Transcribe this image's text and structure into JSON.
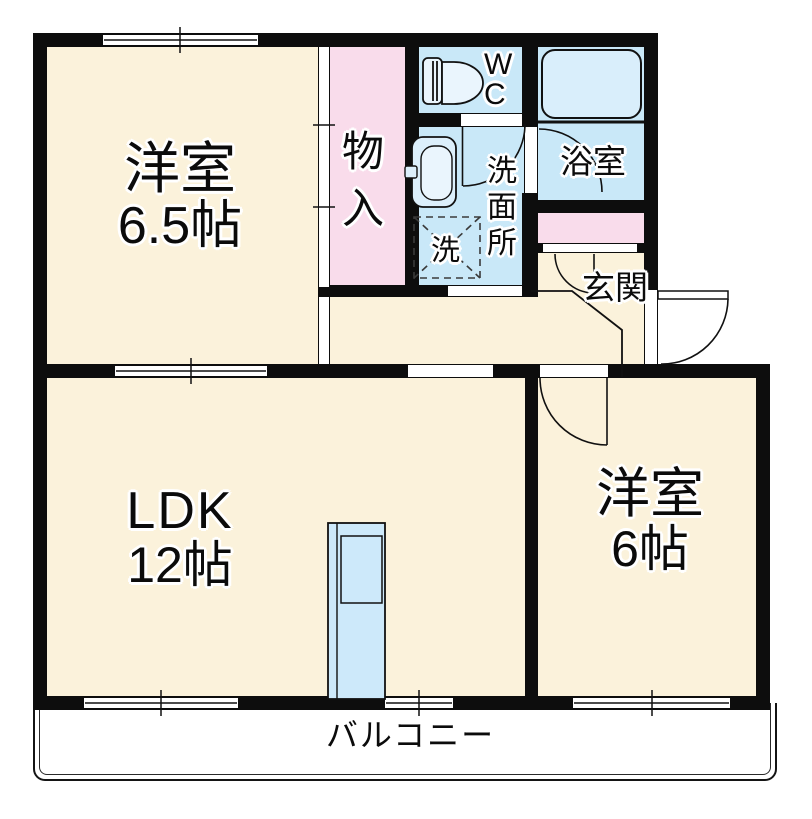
{
  "floorplan": {
    "rooms": {
      "western_room_65": {
        "name": "洋室",
        "size": "6.5帖"
      },
      "storage": {
        "name": "物入"
      },
      "wc": {
        "name": "WC"
      },
      "washroom": {
        "name": "洗面所"
      },
      "washer": {
        "name": "洗"
      },
      "bathroom": {
        "name": "浴室"
      },
      "entrance": {
        "name": "玄関"
      },
      "ldk": {
        "name": "LDK",
        "size": "12帖"
      },
      "western_room_6": {
        "name": "洋室",
        "size": "6帖"
      },
      "balcony": {
        "name": "バルコニー"
      }
    },
    "colors": {
      "floor_cream": "#FBF2DB",
      "wet_area_blue": "#C9E8F8",
      "closet_pink": "#F9DCEB",
      "wall_black": "#0D0D0D",
      "bathtub_blue": "#D9EEFB",
      "glass_door_blue": "#CDE9FA",
      "text_halo": "#FFFFFF"
    },
    "icons": {
      "toilet": "toilet-icon",
      "washbasin": "washbasin-icon",
      "washing_machine": "washing-machine-pan-icon",
      "bathtub": "bathtub-icon",
      "glass_door": "glass-door-icon",
      "door_swings": "door-swing-arc"
    }
  }
}
